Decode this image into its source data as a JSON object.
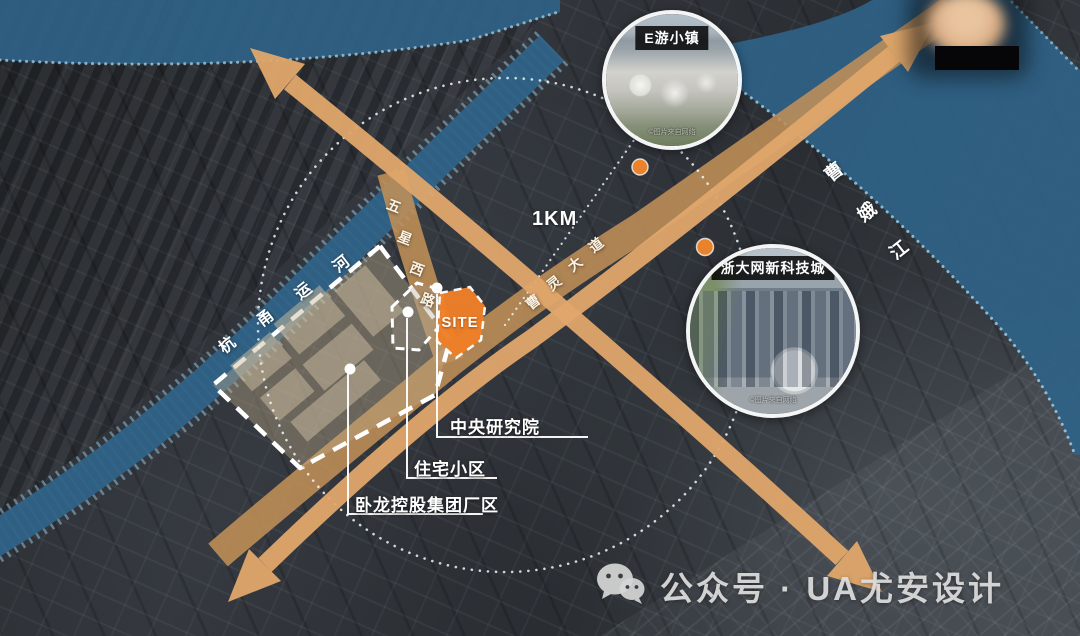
{
  "map": {
    "site": {
      "label": "SITE"
    },
    "scale": {
      "label": "1KM"
    },
    "waterways": {
      "canal": {
        "name": "杭甬运河",
        "chars": [
          "杭",
          "甬",
          "运",
          "河"
        ]
      },
      "river": {
        "name": "曹娥江",
        "chars": [
          "曹",
          "娥",
          "江"
        ]
      }
    },
    "roads": {
      "west_road": {
        "name": "五星西路",
        "chars": [
          "五",
          "星",
          "西",
          "路"
        ]
      },
      "avenue": {
        "name": "曹灵大道",
        "chars": [
          "曹",
          "灵",
          "大",
          "道"
        ]
      }
    },
    "callouts": {
      "research": {
        "label": "中央研究院"
      },
      "residential": {
        "label": "住宅小区"
      },
      "factory": {
        "label": "卧龙控股集团厂区"
      }
    },
    "insets": {
      "etown": {
        "title": "E游小镇",
        "credit": "©图片来自网络"
      },
      "tech_city": {
        "title": "浙大网新科技城",
        "credit": "©图片来自网络"
      }
    }
  },
  "watermark": {
    "text": "公众号 · UA尤安设计"
  },
  "colors": {
    "site_orange": "#ef7f28",
    "arrow": "#e0a76b",
    "road": "#c09058",
    "water": "#2f6287",
    "marker": "#e8832c"
  }
}
